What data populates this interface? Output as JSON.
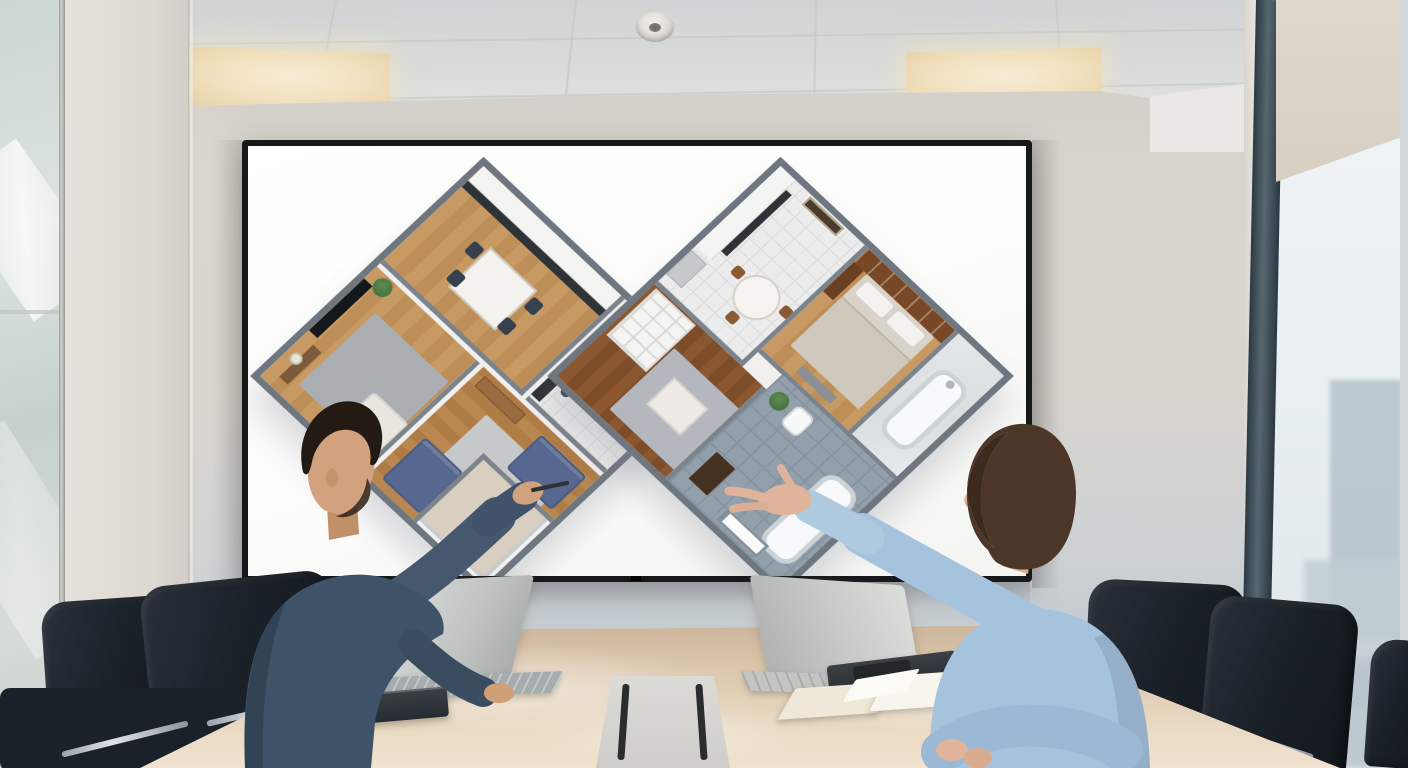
{
  "scene": {
    "type": "photograph",
    "setting": "corporate meeting room",
    "description": "Two people sit at a glossy beige conference table and point at a large wall-mounted display showing a white 3D isometric cutaway floor plan of a furnished apartment"
  },
  "display": {
    "kind": "wall-mounted flat screen",
    "bezel_color": "#17181a",
    "background": "white",
    "content": "3D isometric apartment floor plan, two diamond-shaped wings"
  },
  "floor_plan": {
    "style": "isometric cutaway, top-down dollhouse view",
    "wall_color": "#6e7680",
    "rooms": [
      {
        "name": "tv-lounge",
        "features": "wall TV, white sofa, gray rug, plant, floor lamp",
        "floor": "wood"
      },
      {
        "name": "kitchen-dining",
        "features": "white cabinets, dark counter, dining table with chairs",
        "floor": "wood"
      },
      {
        "name": "living-room",
        "features": "two blue sofas, dark coffee table, sideboard, rug, balcony with glass rail",
        "floor": "herringbone wood"
      },
      {
        "name": "second-kitchen",
        "features": "white cabinets, fridge, round dining table, framed art",
        "floor": "white tile"
      },
      {
        "name": "bedroom",
        "features": "double bed, bookshelf headboard, wardrobe",
        "floor": "wood"
      },
      {
        "name": "bathroom-marble",
        "features": "bathtub",
        "floor": "marble"
      },
      {
        "name": "lounge-nook",
        "features": "white shelving unit, gray rug, white coffee table",
        "floor": "dark wood"
      },
      {
        "name": "bathroom-gray",
        "features": "bathtub, toilet, vanity, plant, window",
        "floor": "gray tile"
      }
    ]
  },
  "people": [
    {
      "position": "left",
      "gender": "man",
      "hair": "short dark brown",
      "facial_hair": "beard stubble",
      "clothing": "dark blue denim shirt",
      "action": "pointing at the plan with a pen, other hand resting on table"
    },
    {
      "position": "right",
      "gender": "woman",
      "hair": "shoulder-length brown bob",
      "clothing": "light blue blouse",
      "action": "gesturing at the plan with open left hand, arms folded on table"
    }
  ],
  "furniture": {
    "table": {
      "shape": "long conference table",
      "finish": "glossy beige wood",
      "center": "recessed cable hatch with dark slots"
    },
    "chairs": {
      "count": 5,
      "style": "high-back black leather with chrome arms"
    },
    "items_on_table": [
      "silver laptop (left, lid toward viewer)",
      "silver laptop (right)",
      "closed dark notebook",
      "open cream notebook",
      "smartphone on dark folio",
      "cable hatch"
    ]
  },
  "room_features": {
    "ceiling": "suspended grid tiles, two warm LED light panels, round smoke detector",
    "left_wall": "frosted glass partition with aluminum mullion",
    "right_wall": "floor-to-ceiling window, dark mullion, beige roller shade, hazy blue city skyline"
  },
  "palette": {
    "back_wall": "#d8d4cd",
    "wall_below_screen": "#c2cbd1",
    "ceiling": "#dbdddc",
    "table_top": "#e2d0b6",
    "chair_leather": "#1b2129",
    "screen_white": "#fbfbfa",
    "denim_shirt": "#3e5268",
    "blue_blouse": "#a6c3dd",
    "skin_man": "#d2a27e",
    "skin_woman": "#e0b49a",
    "window_mullion": "#3c4c58",
    "light_panel": "#f1e0bd",
    "plan_wood": "#c1915a",
    "plan_sofa": "#56688f"
  }
}
